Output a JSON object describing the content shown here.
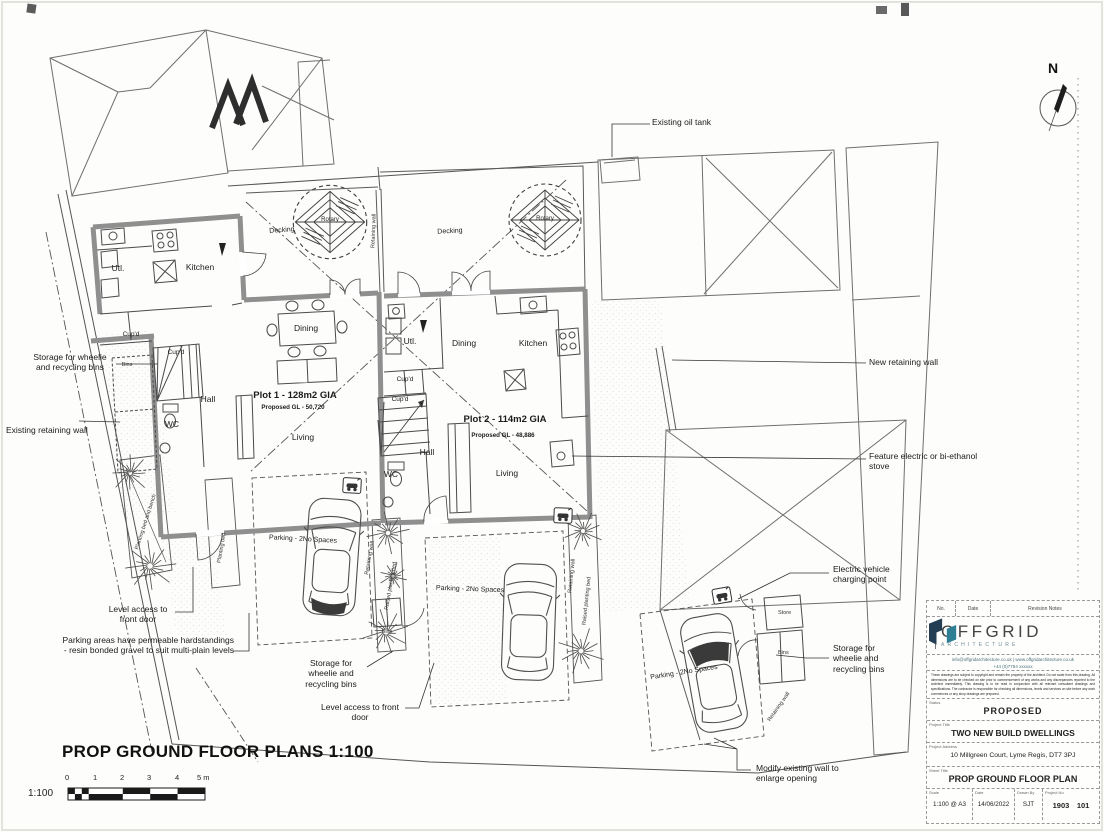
{
  "drawing": {
    "title": "PROP GROUND FLOOR PLANS 1:100",
    "scale_label": "1:100",
    "scale_ticks": [
      "0",
      "1",
      "2",
      "3",
      "4",
      "5 m"
    ],
    "north": "N"
  },
  "plots": {
    "plot1": {
      "name": "Plot 1 - 128m2 GIA",
      "gl": "Proposed GL - 50,720",
      "rooms": {
        "utl": "Utl.",
        "kitchen": "Kitchen",
        "cupd": "Cup'd",
        "bins": "Bins",
        "hall": "Hall",
        "wc": "WC",
        "dining": "Dining",
        "living": "Living"
      }
    },
    "plot2": {
      "name": "Plot 2 - 114m2 GIA",
      "gl": "Proposed GL - 48,886",
      "rooms": {
        "utl": "Utl.",
        "kitchen": "Kitchen",
        "cupd": "Cup'd",
        "hall": "Hall",
        "wc": "WC",
        "dining": "Dining",
        "living": "Living"
      }
    }
  },
  "site": {
    "decking": "Decking",
    "rotary": "Rotary",
    "retaining_wall": "Retaining wall",
    "raised_planting_bed": "Raised planting bed",
    "planting_bed": "Planting bed",
    "planting_bed_bench": "Planting bed and bench",
    "parking": "Parking - 2No Spaces",
    "bins": "Bins",
    "store": "Store"
  },
  "annotations": {
    "oil_tank": "Existing oil tank",
    "new_retaining_wall": "New retaining wall",
    "stove": "Feature electric or bi-ethanol stove",
    "ev": "Electric vehicle charging point",
    "storage_bins": "Storage for wheelie and recycling bins",
    "modify_wall": "Modify existing wall to enlarge opening",
    "existing_retaining_wall": "Existing retaining wall",
    "level_access": "Level access to front door",
    "permeable": "Parking areas have permeable hardstandings - resin bonded gravel to suit multi-plain levels"
  },
  "titleblock": {
    "revision_header": {
      "no": "No.",
      "date": "Date",
      "notes": "Revision Notes"
    },
    "logo": {
      "name": "OFFGRID",
      "sub": "ARCHITECTURE"
    },
    "contact": {
      "line1": "info@offgridarchitecture.co.uk | www.offgridarchitecture.co.uk",
      "line2": "+44 (0)7754 xxxxxx"
    },
    "disclaimer": "These drawings are subject to copyright and remain the property of the architect. Do not scale from this drawing. All dimensions are to be checked on site prior to commencement of any works and any discrepancies reported to the architect immediately. This drawing is to be read in conjunction with all relevant consultant drawings and specifications. The contractor is responsible for checking all dimensions, levels and services on site before any work commences or any shop drawings are prepared.",
    "fields": [
      {
        "label": "Status",
        "value": "PROPOSED"
      },
      {
        "label": "Project Title",
        "value": "TWO NEW BUILD DWELLINGS"
      },
      {
        "label": "Project Address",
        "value": "10 Millgreen Court, Lyme Regis, DT7 3PJ"
      },
      {
        "label": "Sheet Title",
        "value": "PROP GROUND  FLOOR PLAN"
      }
    ],
    "meta": [
      {
        "label": "Scale",
        "value": "1:100 @ A3"
      },
      {
        "label": "Date",
        "value": "14/06/2022"
      },
      {
        "label": "Drawn By",
        "value": "SJT"
      },
      {
        "label": "Project No",
        "value": "1903 101"
      }
    ]
  }
}
